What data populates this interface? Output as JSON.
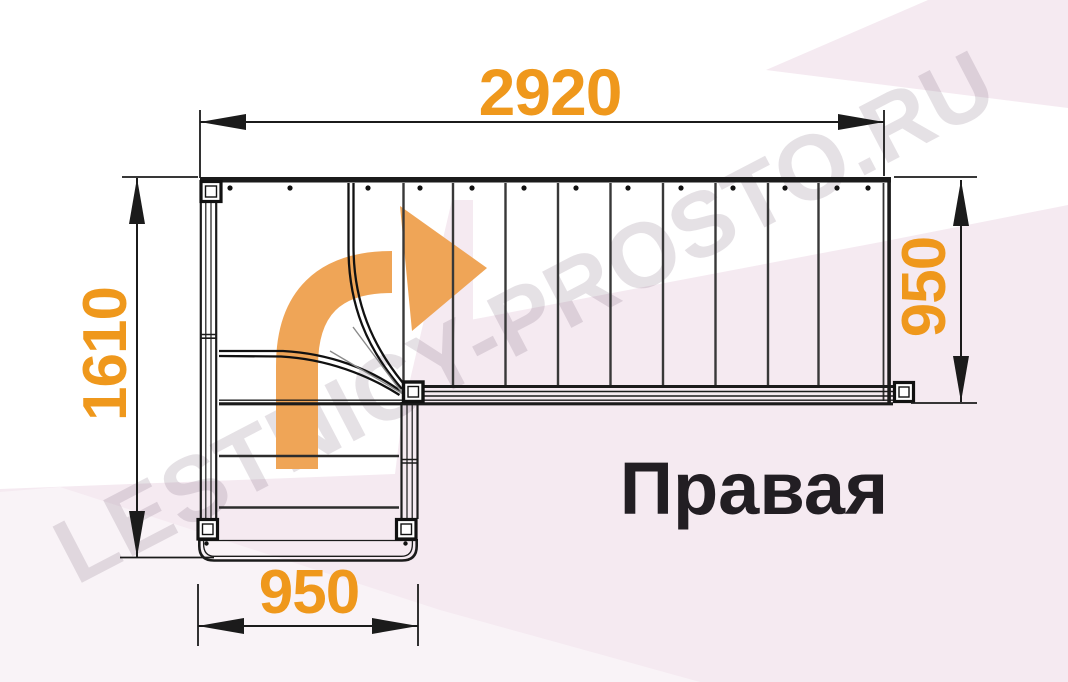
{
  "watermark": {
    "text": "LESTNICY-PROSTO.RU"
  },
  "plan": {
    "label": "Правая",
    "dimensions": {
      "top": "2920",
      "left": "1610",
      "right": "950",
      "bottom": "950"
    },
    "colors": {
      "dimension_text": "#EF981C",
      "direction_arrow": "#EFA557",
      "linework": "#1B1B1B",
      "background_tint": "#F5EAF1",
      "watermark_gray": "#DCD4DA"
    },
    "icons": {
      "direction_arrow": "curved-right-arrow-icon"
    }
  }
}
